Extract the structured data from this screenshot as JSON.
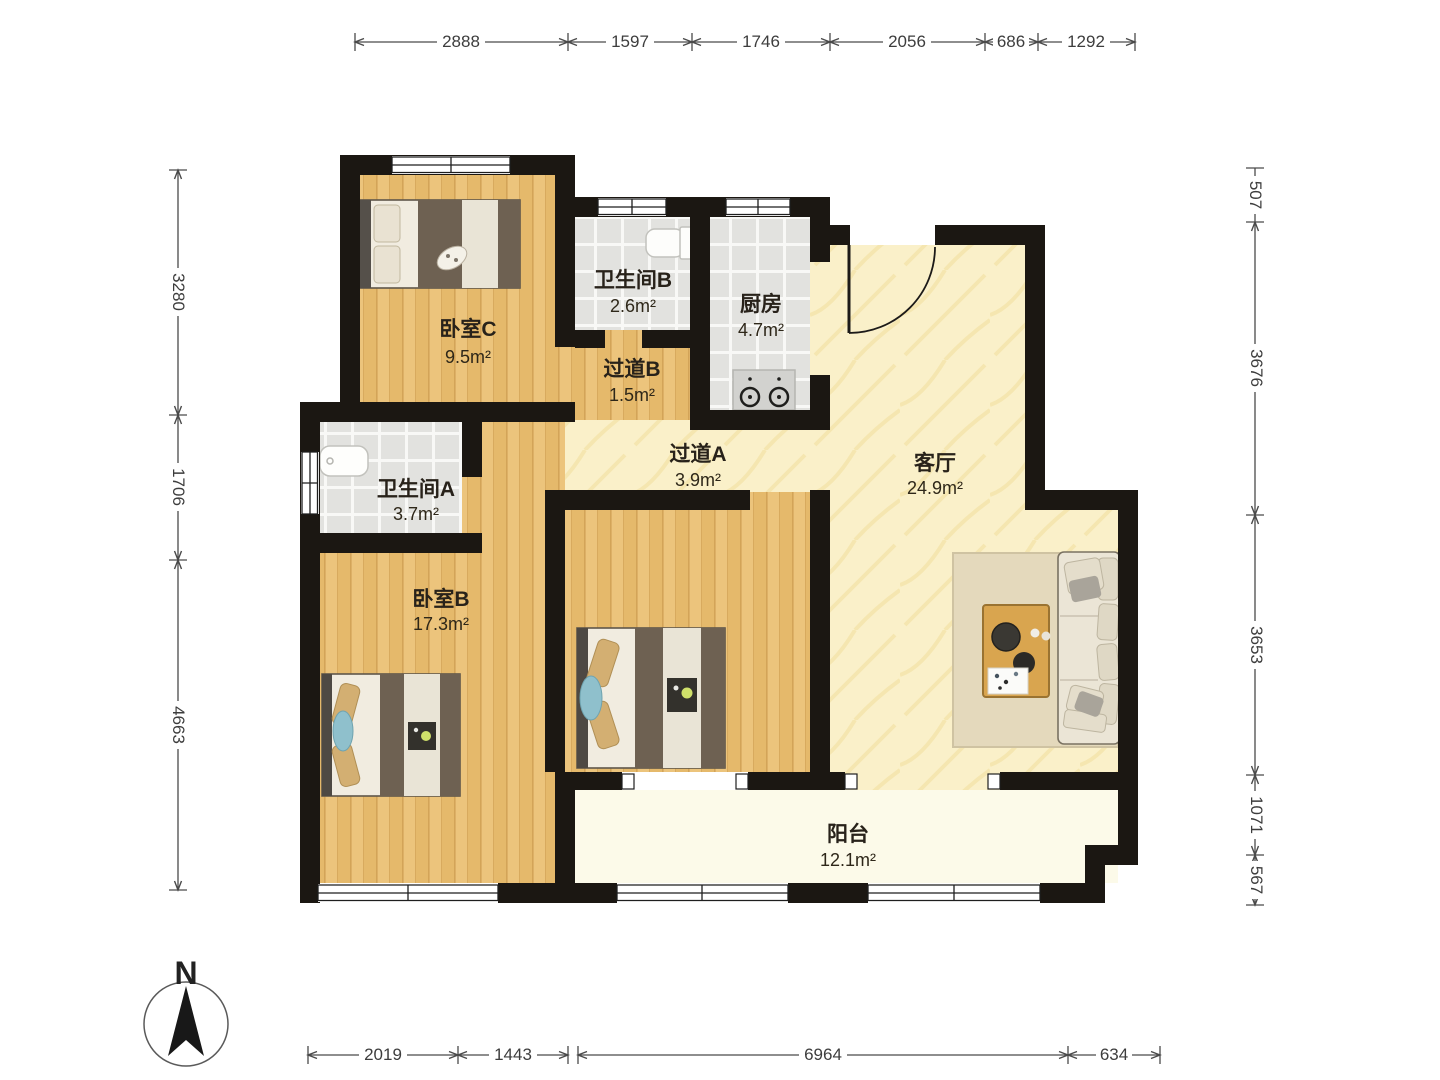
{
  "plan": {
    "type": "apartment-floor-plan",
    "compass_label": "N",
    "rooms": [
      {
        "name": "卧室C",
        "area": "9.5m²"
      },
      {
        "name": "卫生间B",
        "area": "2.6m²"
      },
      {
        "name": "厨房",
        "area": "4.7m²"
      },
      {
        "name": "过道B",
        "area": "1.5m²"
      },
      {
        "name": "过道A",
        "area": "3.9m²"
      },
      {
        "name": "客厅",
        "area": "24.9m²"
      },
      {
        "name": "卫生间A",
        "area": "3.7m²"
      },
      {
        "name": "卧室B",
        "area": "17.3m²"
      },
      {
        "name": "阳台",
        "area": "12.1m²"
      }
    ],
    "dimensions_mm": {
      "top": [
        "2888",
        "1597",
        "1746",
        "2056",
        "686",
        "1292"
      ],
      "left": [
        "3280",
        "1706",
        "4663"
      ],
      "right": [
        "507",
        "3676",
        "3653",
        "1071",
        "567"
      ],
      "bottom": [
        "2019",
        "1443",
        "6964",
        "634"
      ]
    },
    "colors": {
      "wall": "#1b1712",
      "wood_floor": "#ecc47c",
      "tile_floor": "#e2e2df",
      "marble_floor": "#faf0c9",
      "balcony_floor": "#fcfae9",
      "blanket": "#6e6152",
      "pillow_tan": "#d3af72",
      "pillow_blue": "#8fc0cc",
      "sofa": "#ebe5d6",
      "table_wood": "#d9a54f",
      "dim_text": "#3d3d3d"
    }
  }
}
